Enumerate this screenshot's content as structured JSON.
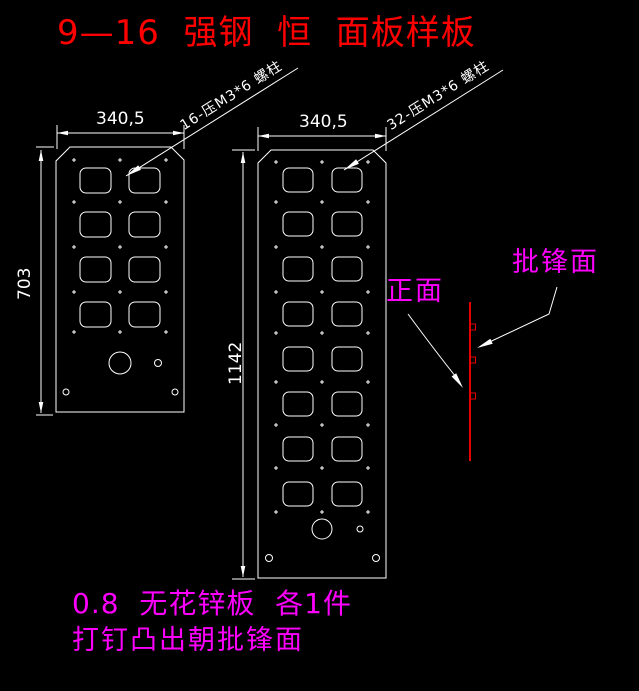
{
  "title": "9—16  强钢  恒  面板样板",
  "colors": {
    "background": "#000000",
    "linework": "#ffffff",
    "title_red": "#ff0000",
    "annotation_magenta": "#ff00ff",
    "side_view_red": "#e60000"
  },
  "panels": {
    "left": {
      "width_label": "340,5",
      "height_label": "703",
      "stud_note": "16-压M3*6 螺柱",
      "cutout_rows": 4,
      "cutout_cols": 2
    },
    "right": {
      "width_label": "340,5",
      "height_label": "1142",
      "stud_note": "32-压M3*6 螺柱",
      "cutout_rows": 8,
      "cutout_cols": 2
    }
  },
  "side_view": {
    "front_label": "正面",
    "burr_label": "批锋面"
  },
  "notes": {
    "material": "0.8  无花锌板  各1件",
    "instruction": "打钉凸出朝批锋面"
  }
}
